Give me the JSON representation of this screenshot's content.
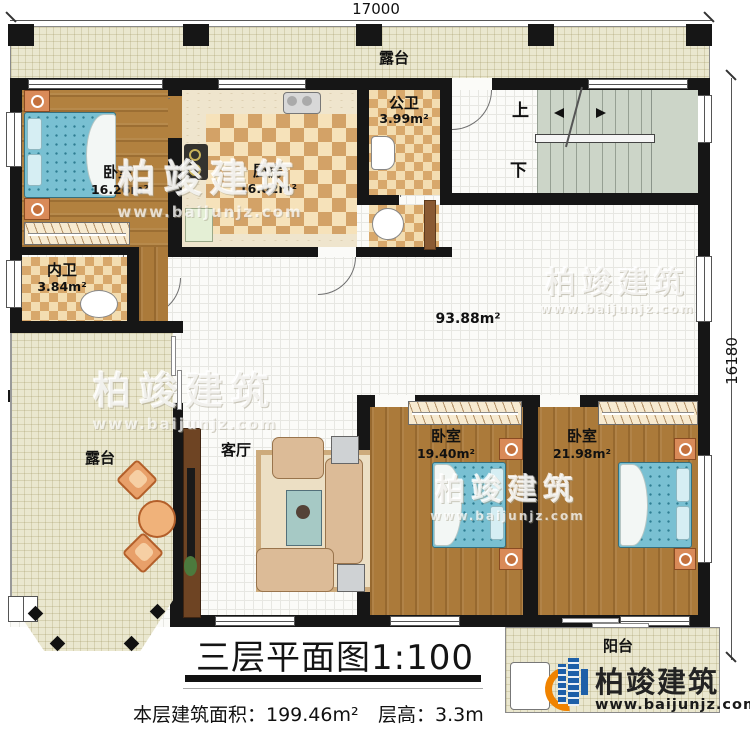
{
  "dimensions": {
    "width_top": "17000",
    "height_right": "16180"
  },
  "title": "三层平面图1:100",
  "stats": {
    "floor_area": "本层建筑面积：199.46m²",
    "floor_height": "层高：3.3m"
  },
  "rooms": {
    "terrace_top": "露台",
    "terrace_sw": "露台",
    "bedroom_nw": {
      "name": "卧室",
      "area": "16.26m²"
    },
    "kitchen": {
      "name": "厨房",
      "area": "16.02m²"
    },
    "bath_public": {
      "name": "公卫",
      "area": "3.99m²"
    },
    "bath_private": {
      "name": "内卫",
      "area": "3.84m²"
    },
    "living": "客厅",
    "bedroom_s1": {
      "name": "卧室",
      "area": "19.40m²"
    },
    "bedroom_s2": {
      "name": "卧室",
      "area": "21.98m²"
    },
    "balcony": "阳台",
    "hall_area": "93.88m²"
  },
  "stairs": {
    "up": "上",
    "down": "下"
  },
  "branding": {
    "name": "柏竣建筑",
    "url": "www.baijunjz.com"
  },
  "colors": {
    "accent_blue": "#1d5fa8",
    "accent_orange": "#f08300",
    "wall": "#161616"
  }
}
